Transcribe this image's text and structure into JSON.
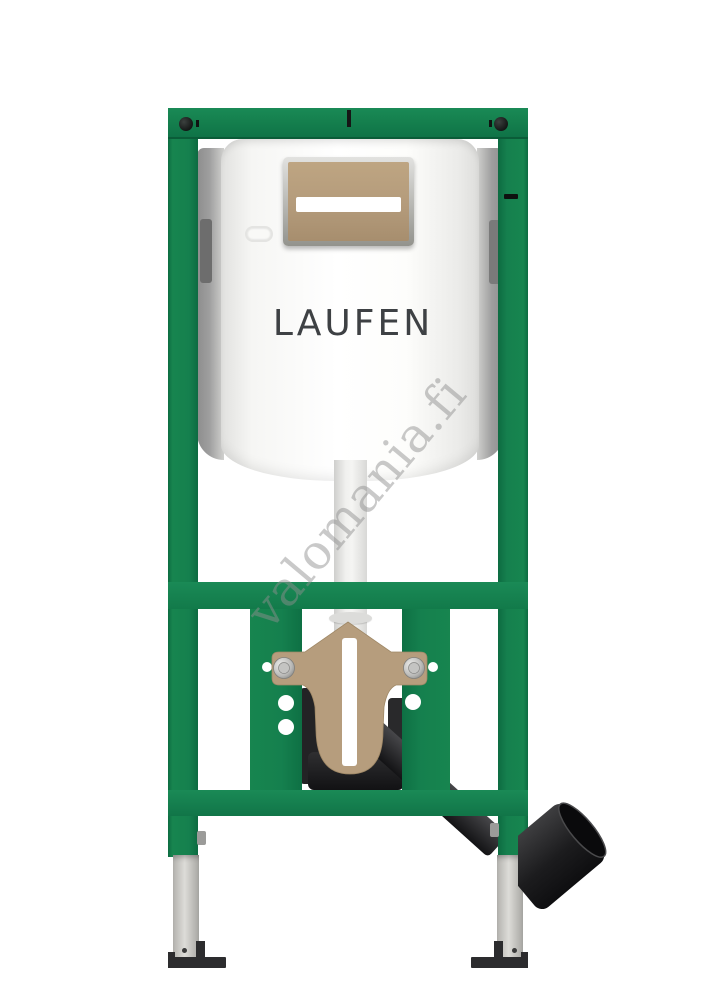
{
  "watermark": {
    "text": "valomania.fi",
    "color": "#8f8f8f"
  },
  "product": {
    "brand": "LAUFEN",
    "type": "wall-hung WC installation frame with concealed cistern",
    "colors": {
      "frame_green": "#15804E",
      "frame_green_dark": "#0D6B41",
      "flush_plate_tan": "#B49B7B",
      "cistern_white": "#FCFCFC",
      "drain_pipe_black": "#1A1B1D",
      "foot_silver": "#C6C5C1",
      "foot_plate_black": "#2C2C2E"
    }
  }
}
